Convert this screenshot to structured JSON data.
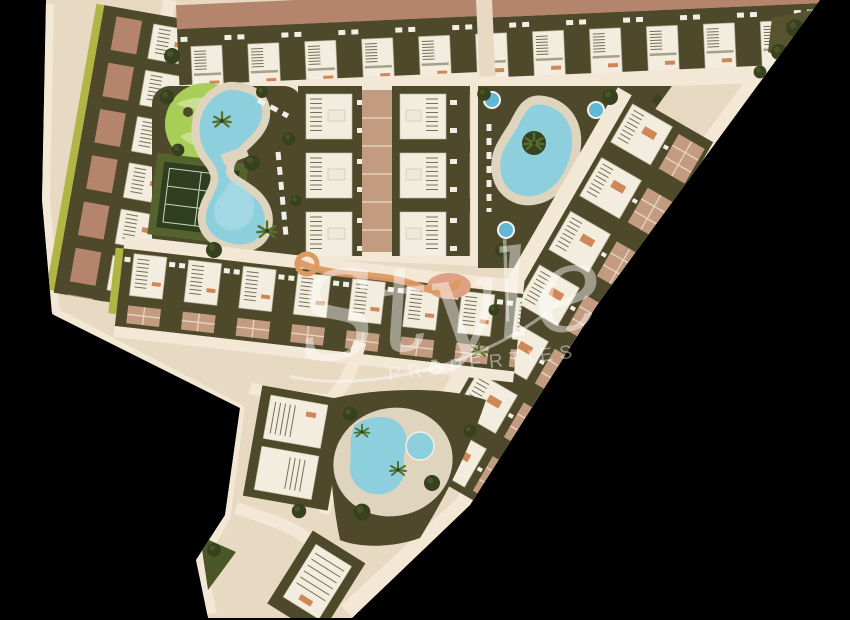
{
  "watermark": {
    "brand": "Style",
    "subtitle": "PROPERTIES"
  },
  "palette": {
    "background": "#000000",
    "site_base": "#e8d9c3",
    "road": "#f3e7d5",
    "garden_olive": "#4e492b",
    "bright_green": "#a8ce58",
    "bright_green_light": "#c9e08f",
    "water": "#8ecfdd",
    "water_deep": "#5fb9d6",
    "deck": "#dfd4bd",
    "roof_terracotta": "#b5846c",
    "roof_white": "#f2edde",
    "stripe": "#776f58",
    "paving": "#c29b80",
    "paving_line": "#eadcc6",
    "court_outer": "#55622d",
    "court_inner": "#2e3e1e",
    "court_line": "#ccd5bf",
    "tree": "#37411f",
    "palm": "#53702c",
    "hedge": "#b0b544",
    "orange_path": "#dc9a63",
    "salmon": "#dfa183",
    "watermark": "#ffffff"
  }
}
